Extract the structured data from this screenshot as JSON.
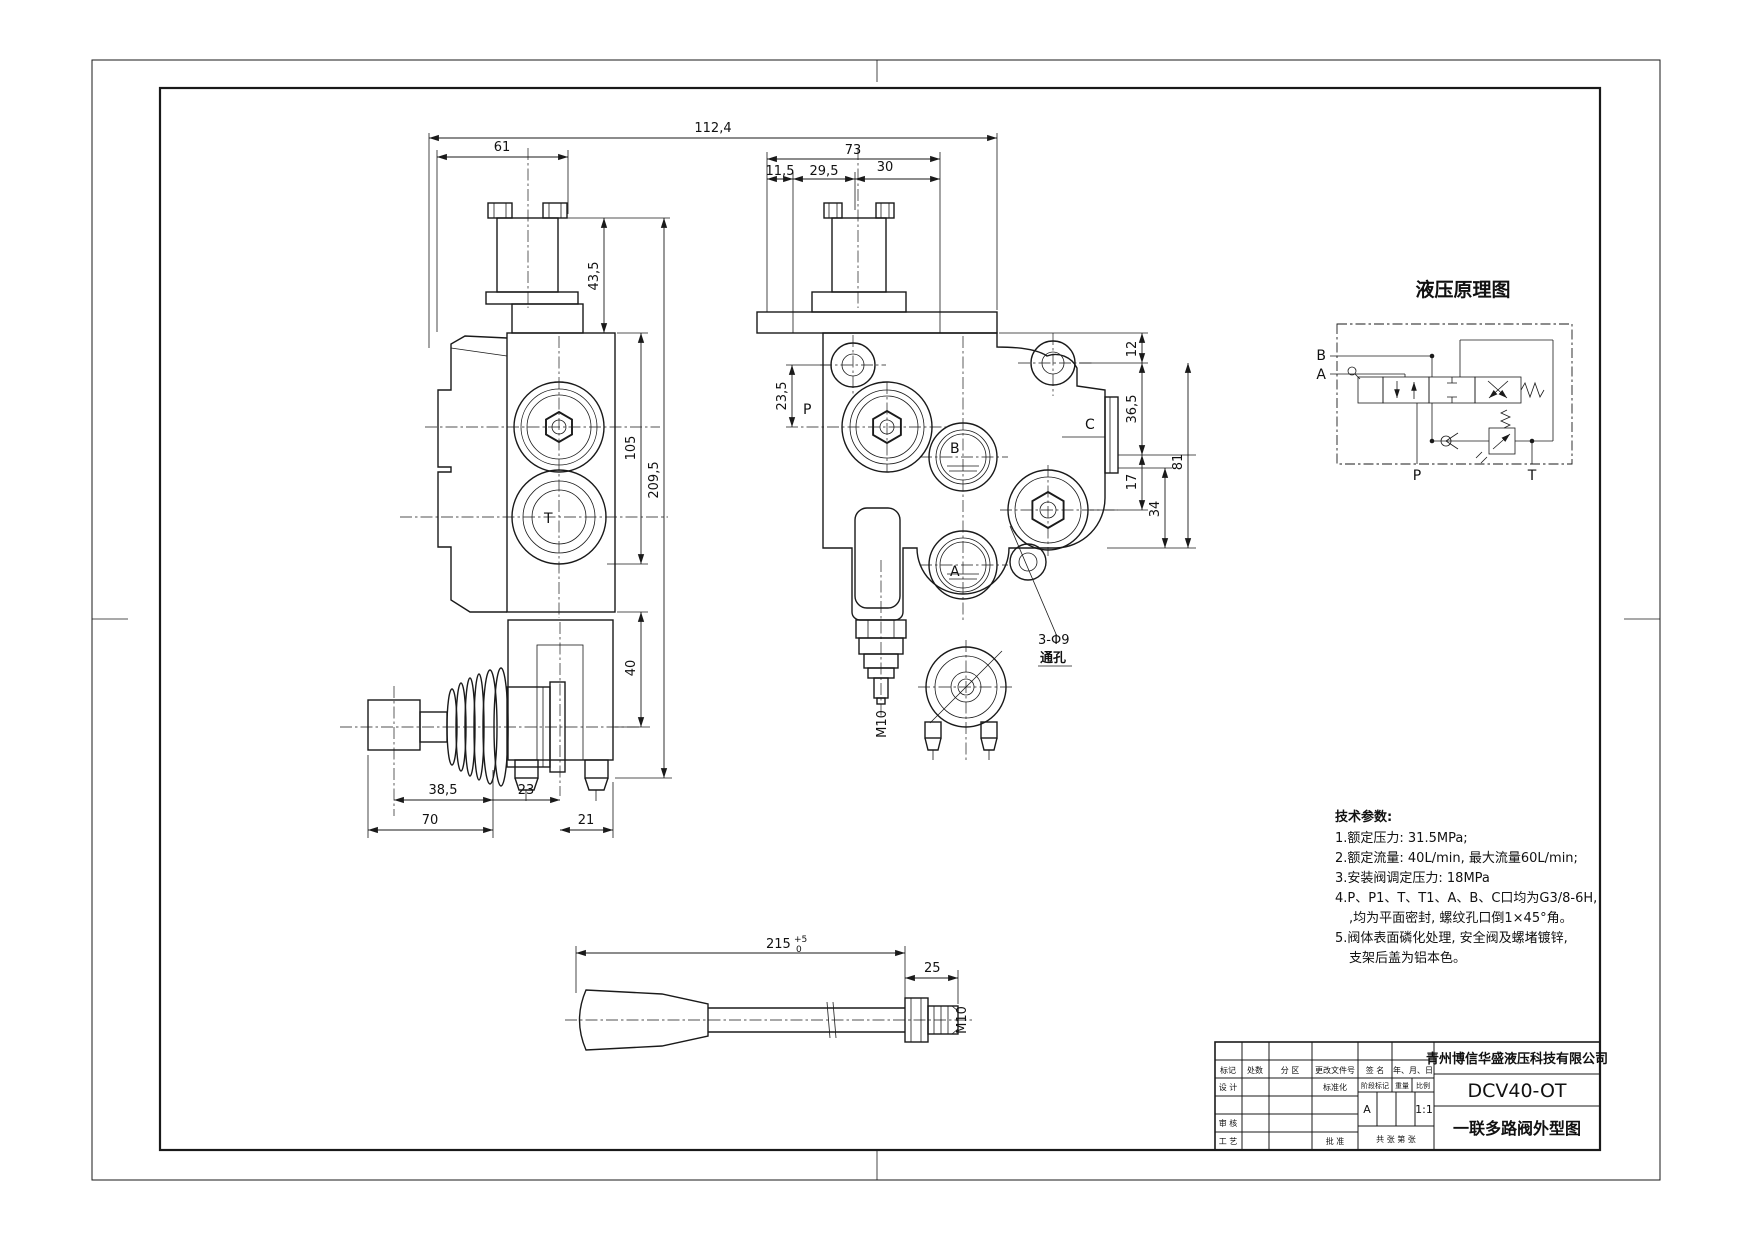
{
  "drawing": {
    "dims": {
      "d112_4": "112,4",
      "d61": "61",
      "d43_5": "43,5",
      "d105": "105",
      "d209_5": "209,5",
      "d40": "40",
      "d38_5": "38,5",
      "d23": "23",
      "d70": "70",
      "d21": "21",
      "d73": "73",
      "d11_5": "11,5",
      "d29_5": "29,5",
      "d30": "30",
      "d23_5": "23,5",
      "d12": "12",
      "d36_5": "36,5",
      "d17": "17",
      "d34": "34",
      "d81": "81",
      "d215": "215",
      "tol_top": "+5",
      "tol_bot": "0",
      "d25": "25",
      "m10": "M10",
      "holes1": "3-Φ9",
      "holes2": "通孔"
    },
    "ports": {
      "p": "P",
      "b": "B",
      "a": "A",
      "c": "C",
      "t": "T"
    }
  },
  "schematic": {
    "title": "液压原理图",
    "port_b": "B",
    "port_a": "A",
    "port_p": "P",
    "port_t": "T"
  },
  "tech_params": {
    "heading": "技术参数:",
    "lines": [
      "1.额定压力: 31.5MPa;",
      "2.额定流量: 40L/min, 最大流量60L/min;",
      "3.安装阀调定压力: 18MPa",
      "4.P、P1、T、T1、A、B、C口均为G3/8-6H,",
      ",均为平面密封, 螺纹孔口倒1×45°角。",
      "5.阀体表面磷化处理, 安全阀及螺堵镀锌,",
      "支架后盖为铝本色。"
    ]
  },
  "title_block": {
    "company": "青州博信华盛液压科技有限公司",
    "part_number": "DCV40-OT",
    "drawing_title": "一联多路阀外型图",
    "stage_mark": "A",
    "scale_value": "1:1",
    "rev_headers": [
      "标记",
      "处数",
      "分 区",
      "更改文件号",
      "签 名",
      "年、月、日"
    ],
    "labels": {
      "design": "设 计",
      "standardize": "标准化",
      "review": "审 核",
      "craft": "工 艺",
      "approve": "批 准",
      "stage": "阶段标记",
      "weight": "重量",
      "scale": "比例",
      "sheets": "共  张 第  张"
    }
  }
}
